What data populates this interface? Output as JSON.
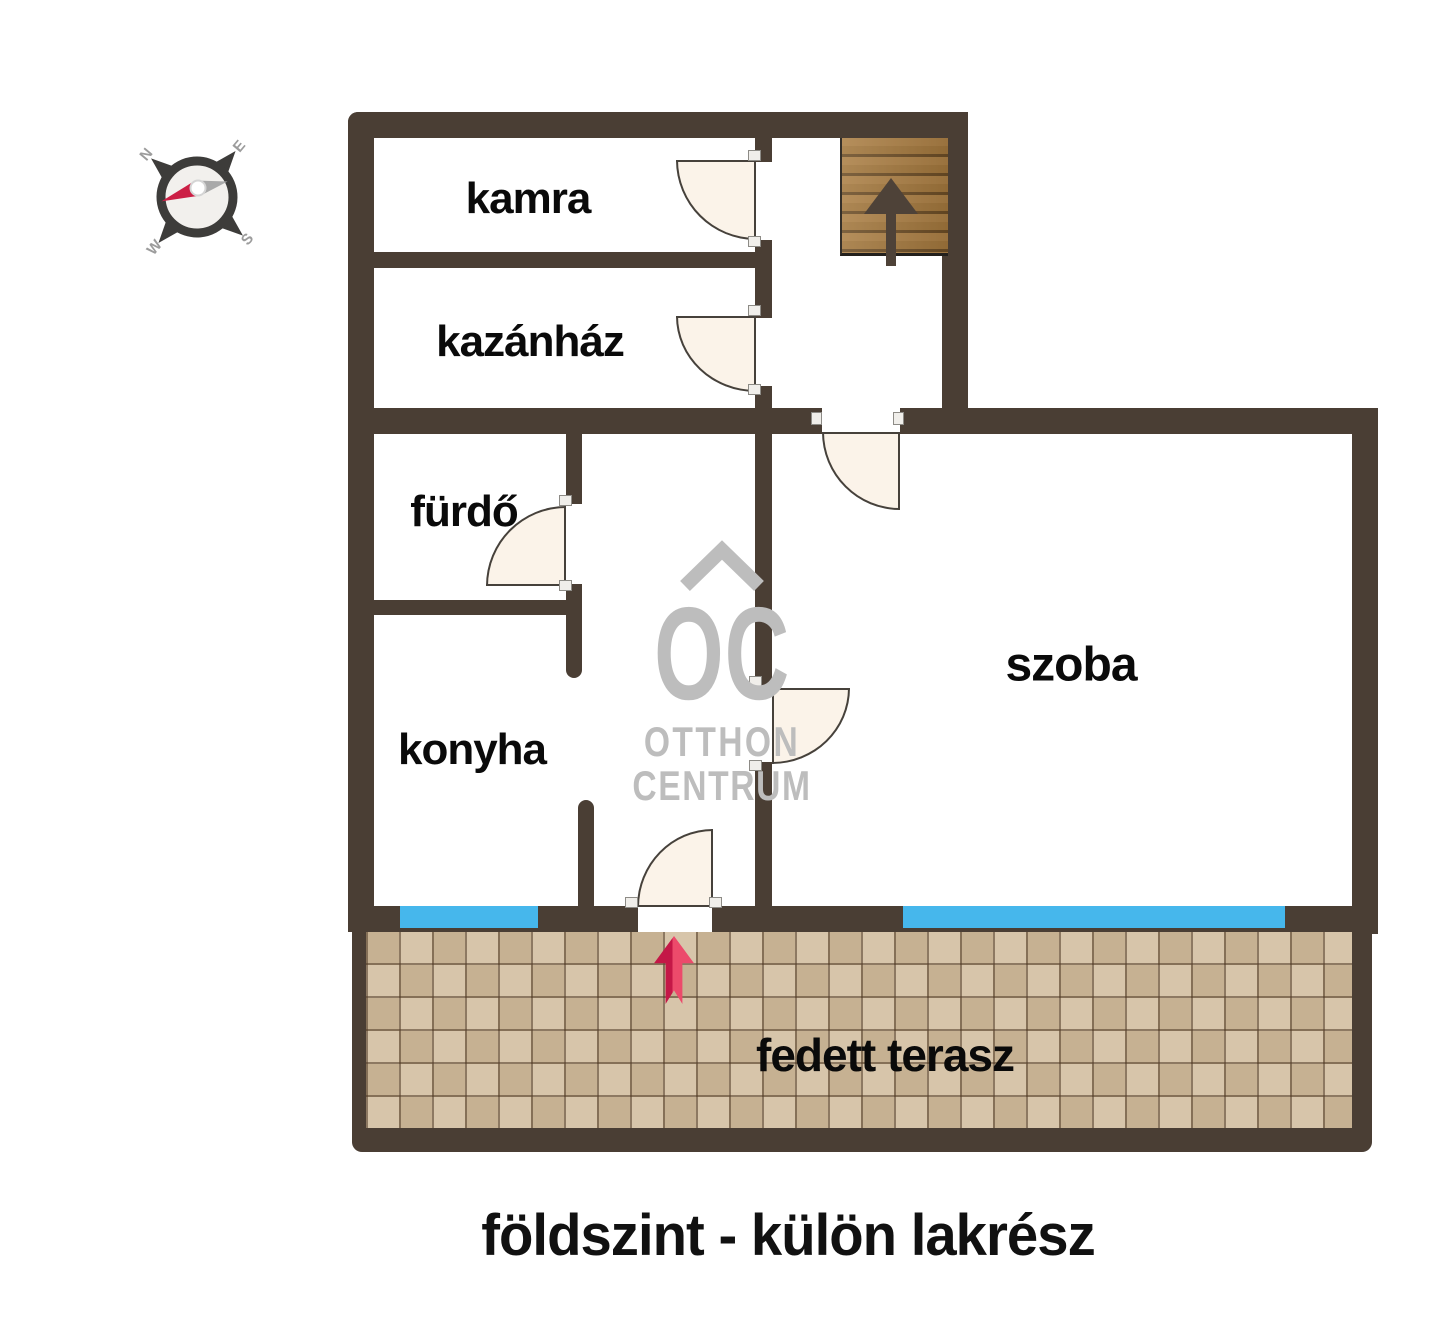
{
  "title": "földszint - külön lakrész",
  "rooms": {
    "kamra": {
      "label": "kamra"
    },
    "kazanhaz": {
      "label": "kazánház"
    },
    "furdo": {
      "label": "fürdő"
    },
    "konyha": {
      "label": "konyha"
    },
    "szoba": {
      "label": "szoba"
    },
    "terasz": {
      "label": "fedett terasz"
    }
  },
  "watermark": {
    "logo": "OC",
    "line1": "OTTHON",
    "line2": "CENTRUM"
  },
  "compass": {
    "n": "N",
    "e": "E",
    "s": "S",
    "w": "W"
  },
  "stairs": {
    "direction": "up"
  },
  "colors": {
    "wall": "#4a3e34",
    "window": "#46b7ec",
    "door_fill": "#fbf3e9",
    "tile_base": "#cdb89b",
    "stair_wood": "#a1763c",
    "entry_arrow": "#dd2c57",
    "watermark": "#bdbdbd",
    "label_text": "#0a0a0a"
  }
}
